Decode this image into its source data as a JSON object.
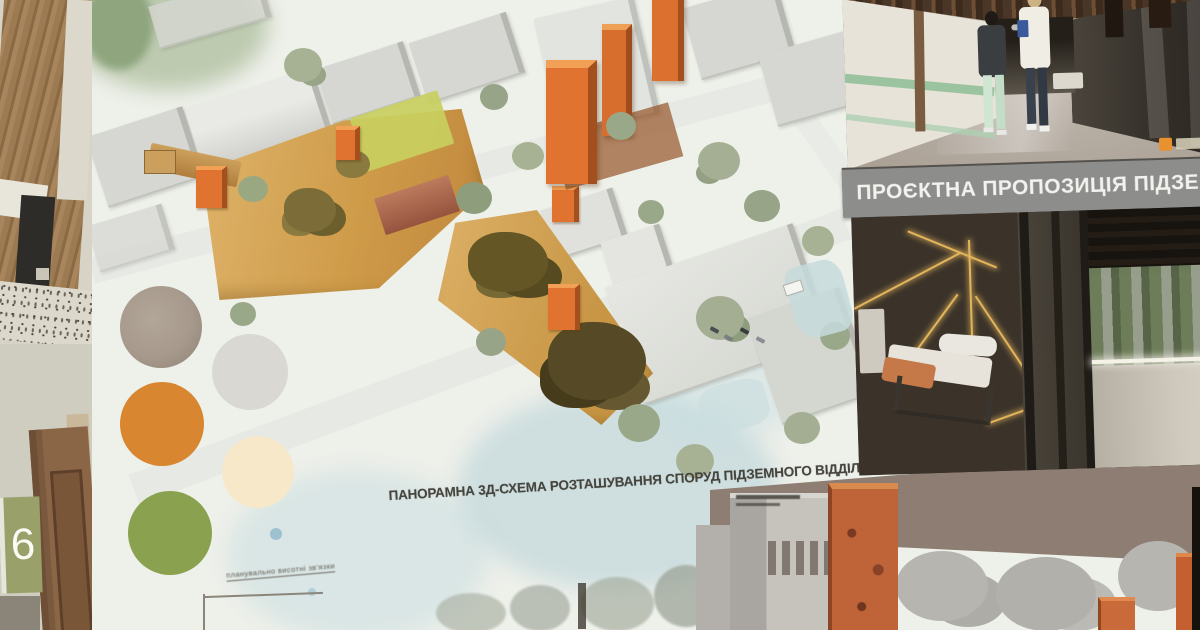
{
  "poster": {
    "caption": "ПАНОРАМНА 3Д-СХЕМА РОЗТАШУВАННЯ СПОРУД ПІДЗЕМНОГО ВІДДІЛЕННЯ (з боку вул. Трінклера)",
    "callout_label": "планувально висотні зв'язки",
    "legend": {
      "circle_colors": [
        "#a79a8d",
        "#d9d8d3",
        "#d8862f",
        "#f6e8c9",
        "#8aa24f"
      ]
    },
    "plan_colors": {
      "accent_orange": "#e0732f",
      "courtyard_tan": "#d2a254",
      "building_gray": "#d6d7d2",
      "watercolor_blue": "#c8dde2"
    }
  },
  "right_panel": {
    "title": "ПРОЄКТНА ПРОПОЗИЦІЯ ПІДЗЕМНОГО",
    "title_bar_color": "#8d8d8b",
    "badge_color": "#e8922f"
  },
  "environment": {
    "door_sign": "6"
  }
}
